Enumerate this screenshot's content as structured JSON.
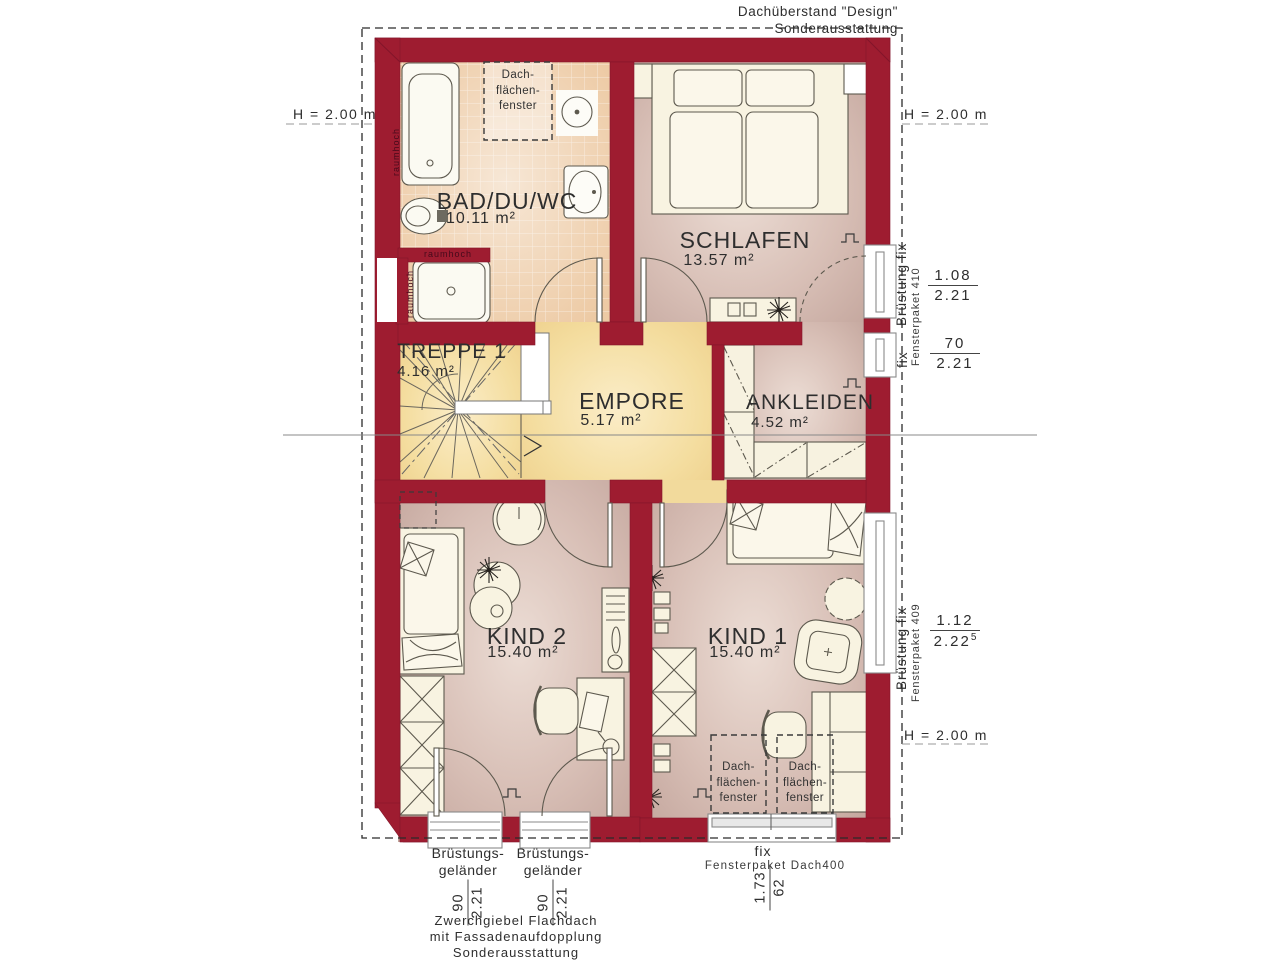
{
  "title_note": {
    "line1": "Dachüberstand \"Design\"",
    "line2": "Sonderausstattung"
  },
  "height_marks": {
    "left": "H = 2.00 m",
    "right_top": "H = 2.00 m",
    "right_bottom": "H = 2.00 m"
  },
  "rooms": {
    "bad": {
      "name": "BAD/DU/WC",
      "area": "10.11 m²"
    },
    "schlafen": {
      "name": "SCHLAFEN",
      "area": "13.57 m²"
    },
    "treppe": {
      "name": "TREPPE 1",
      "area": "4.16 m²"
    },
    "empore": {
      "name": "EMPORE",
      "area": "5.17 m²"
    },
    "ankleiden": {
      "name": "ANKLEIDEN",
      "area": "4.52 m²"
    },
    "kind2": {
      "name": "KIND 2",
      "area": "15.40 m²"
    },
    "kind1": {
      "name": "KIND 1",
      "area": "15.40 m²"
    }
  },
  "roof_window_label": {
    "line1": "Dach-",
    "line2": "flächen-",
    "line3": "fenster"
  },
  "wall_label": {
    "raumhoch": "raumhoch"
  },
  "window_right_top": {
    "label": "Brüstung fix",
    "package": "Fensterpaket 410",
    "dim_upper": {
      "num": "1.08",
      "den": "2.21"
    },
    "fix": "fix",
    "dim_lower": {
      "num": "70",
      "den": "2.21"
    }
  },
  "window_right_mid": {
    "label": "Brüstung fix",
    "package": "Fensterpaket 409",
    "dim": {
      "num": "1.12",
      "den": "2.22",
      "sup": "5"
    }
  },
  "balcony_doors": {
    "label_line1": "Brüstungs-",
    "label_line2": "geländer",
    "dim": {
      "num": "90",
      "den": "2.21"
    }
  },
  "roof_package": {
    "fix": "fix",
    "label": "Fensterpaket Dach400",
    "dim": {
      "num": "1.73",
      "den": "62"
    }
  },
  "footer_note": {
    "line1": "Zwerchgiebel Flachdach",
    "line2": "mit Fassadenaufdopplung",
    "line3": "Sonderausstattung"
  },
  "colors": {
    "wall": "#9e1c30",
    "stair_floor": "#f3dc9e",
    "tile_floor": "#edcaa4",
    "room_floor": "#d9c0b7"
  }
}
